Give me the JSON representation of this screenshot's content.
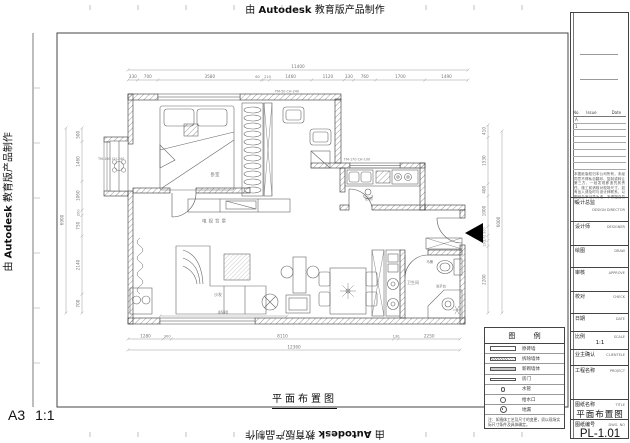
{
  "stamp": {
    "prefix": "由",
    "brand": "Autodesk",
    "suffix": "教育版产品制作"
  },
  "sheet": {
    "format": "A3",
    "scale": "1:1",
    "drawing_title": "平面布置图"
  },
  "title_block": {
    "revision": {
      "headers": [
        "No.",
        "Issue",
        "Date"
      ],
      "rows": [
        "A",
        "1",
        "",
        "",
        "",
        "",
        "",
        ""
      ]
    },
    "note": "本图纸版权归本公司所有，未经同意不得私自翻印、复制或转让第三方，一经发现即追究其责任。施工前请核对现场尺寸，如有出入请及时与设计师联系，以图纸会审记录为准，不得擅自变更。",
    "fields": [
      {
        "cn": "设计总监",
        "en": "DESIGN DIRECTOR"
      },
      {
        "cn": "设计师",
        "en": "DESIGNER"
      },
      {
        "cn": "绘图",
        "en": "DRAW"
      },
      {
        "cn": "审核",
        "en": "APPROVE"
      },
      {
        "cn": "校对",
        "en": "CHECK"
      },
      {
        "cn": "日期",
        "en": "DATE"
      },
      {
        "cn": "比例",
        "en": "SCALE"
      },
      {
        "cn": "业主确认",
        "en": "CLIENTELE"
      },
      {
        "cn": "工程名称",
        "en": "PROJECT"
      },
      {
        "cn": "图纸名称",
        "en": "TITLE"
      },
      {
        "cn": "图纸编号",
        "en": "DWG. NO"
      }
    ],
    "scale_value": "1:1",
    "title_value": "平面布置图",
    "dwg_no_value": "PL-1.01"
  },
  "legend": {
    "title": "图 例",
    "items": [
      {
        "label": "原砖墙"
      },
      {
        "label": "拆除墙体"
      },
      {
        "label": "新砌墙体"
      },
      {
        "label": "房门"
      },
      {
        "label": "水管"
      },
      {
        "label": "给水口"
      },
      {
        "label": "地漏"
      }
    ],
    "note": "注：如墙体工艺及尺寸的变更，须以现场实际尺寸条件及具体确定。"
  },
  "plan": {
    "rooms": {
      "bedroom": "卧室",
      "tv_wall": "电视背景",
      "sofa": "沙发",
      "kitchen": "厨房",
      "bath": "卫生间",
      "toilet": "马桶",
      "basin": "洗手台"
    },
    "window_tags": [
      "TM-50 CH-240",
      "TM-160 CH-240",
      "TM-170 CH-100"
    ],
    "dims": {
      "top_overall": "11400",
      "top": [
        "330",
        "700",
        "3580",
        "60",
        "210",
        "1460",
        "1120",
        "330",
        "760",
        "1700",
        "1490"
      ],
      "left_overall": "6900",
      "left": [
        "500",
        "1460",
        "1060",
        "200",
        "750",
        "2140",
        "700"
      ],
      "right_overall": "6000",
      "right": [
        "410",
        "1530",
        "400",
        "1000",
        "300",
        "170",
        "190",
        "2200"
      ],
      "bottom_overall": "12360",
      "bottom": [
        "1280",
        "300",
        "8110",
        "130",
        "2250"
      ],
      "sofa": "4680"
    }
  }
}
